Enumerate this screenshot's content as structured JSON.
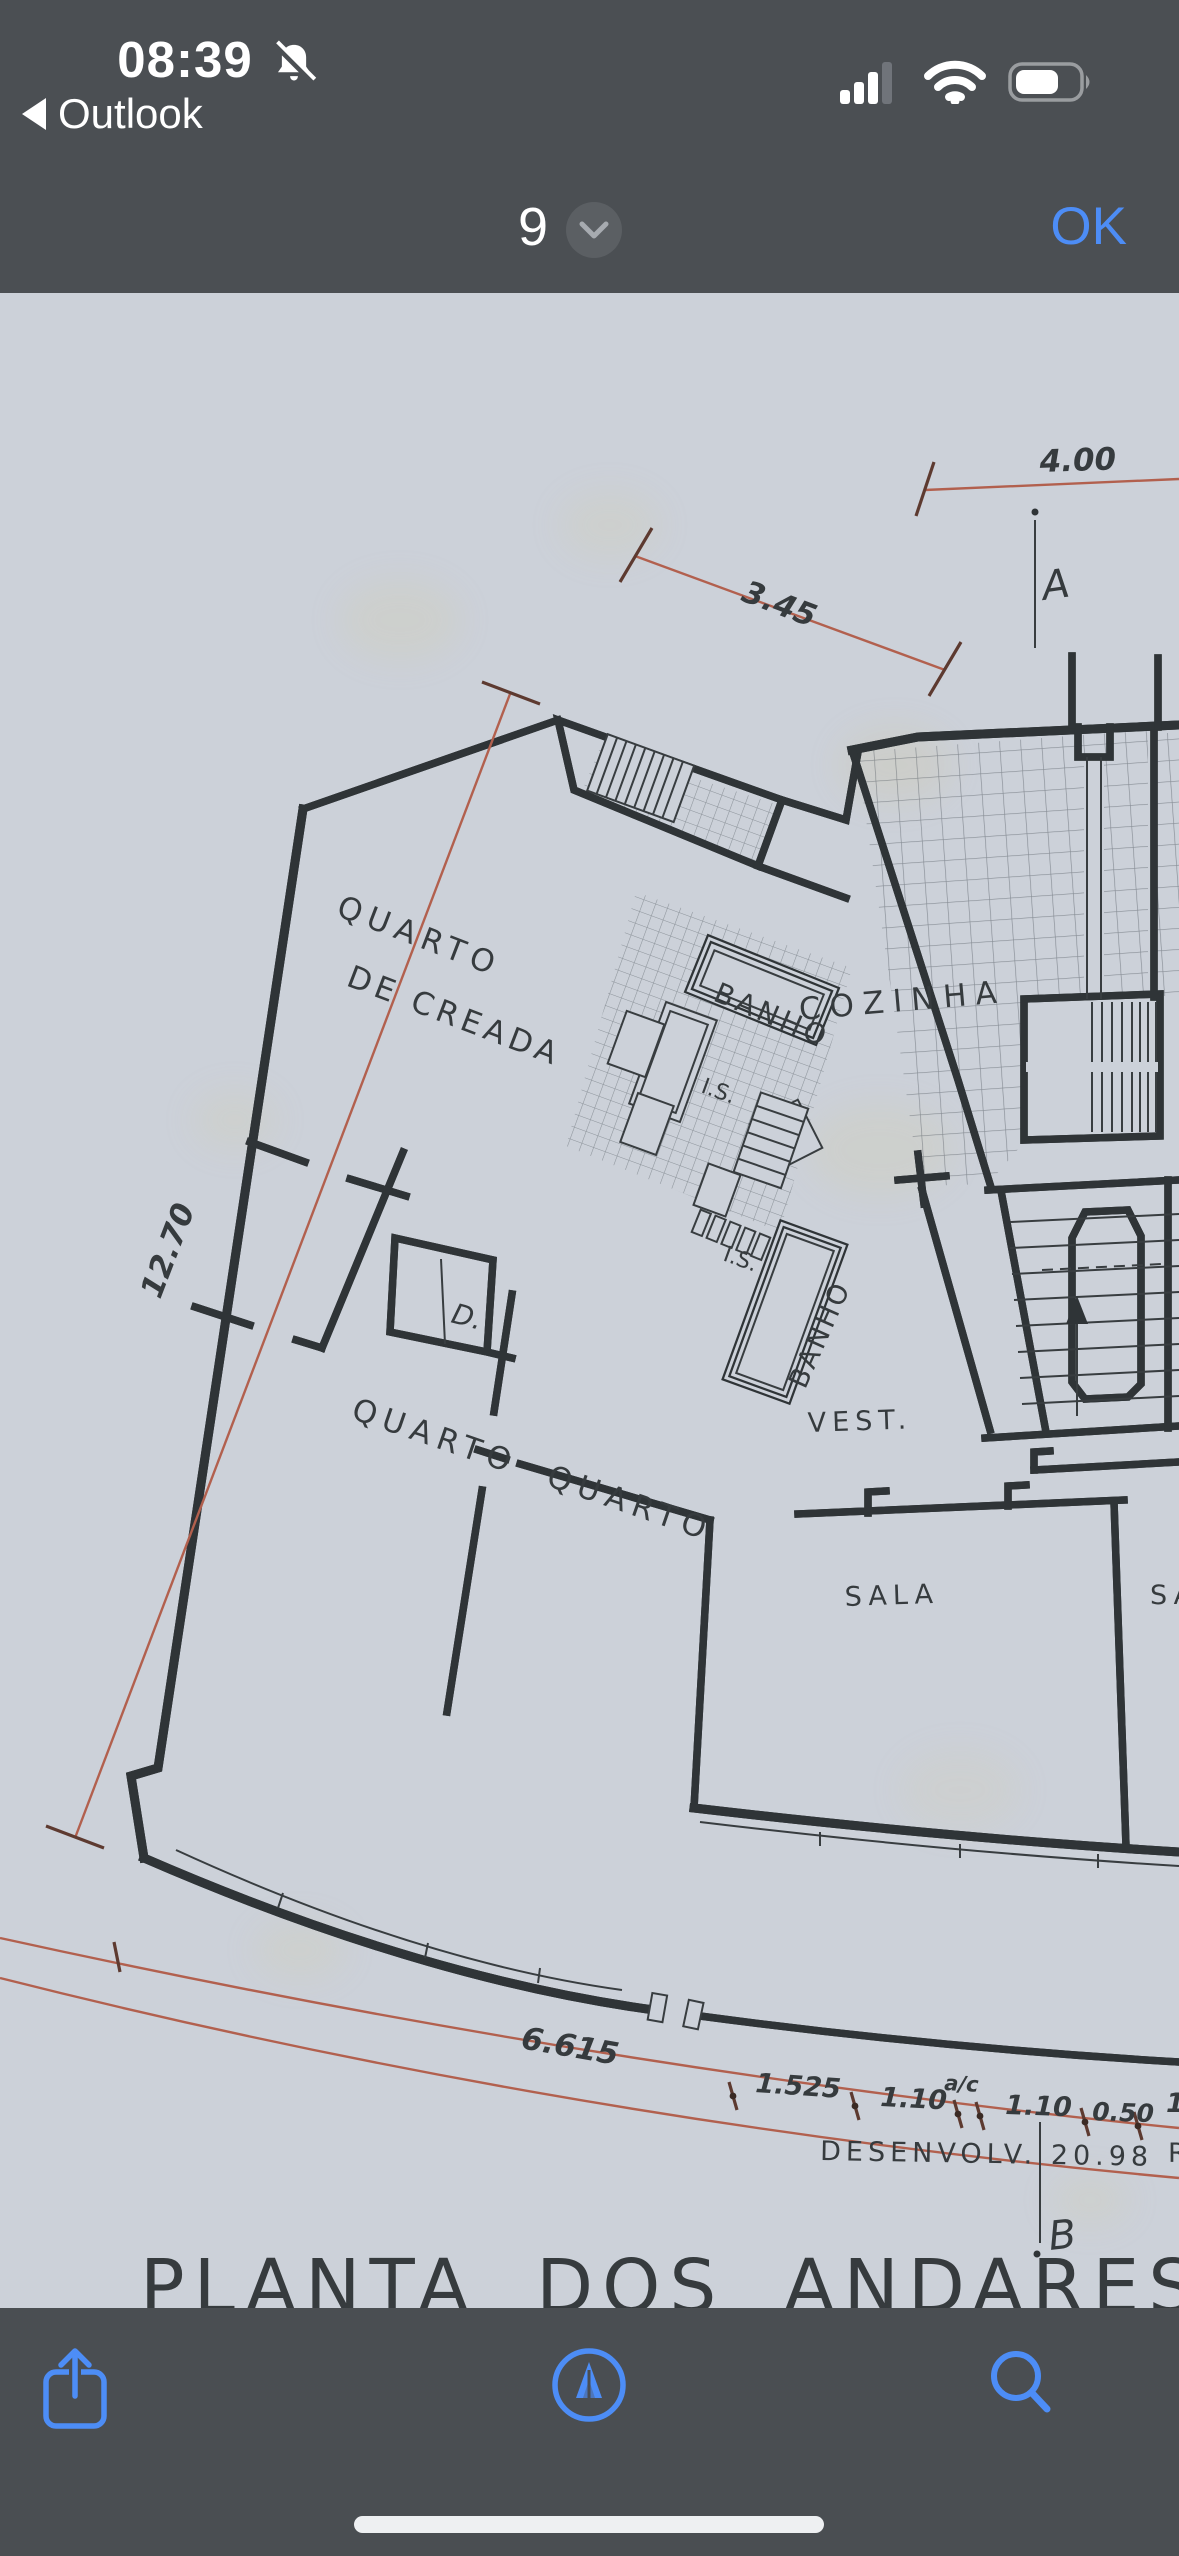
{
  "status_bar": {
    "time": "08:39",
    "back_label": "Outlook",
    "icons": [
      "notifications-off-icon",
      "cellular-signal-icon",
      "wifi-icon",
      "battery-icon"
    ]
  },
  "nav_bar": {
    "page_number": "9",
    "confirm_label": "OK"
  },
  "document": {
    "title": "PLANTA  DOS  ANDARES",
    "rooms": {
      "maid_room_line1": "QUARTO",
      "maid_room_line2": "DE CREADA",
      "bath1": "BANHO",
      "bath2": "BANHO",
      "wc1": "I.S.",
      "wc2": "I.S.",
      "kitchen": "COZINHA",
      "closet": "D.",
      "bedroom1": "QUARTO",
      "bedroom2": "QUARTO",
      "vestibule": "VEST.",
      "living": "SALA",
      "living2_partial": "SA"
    },
    "dimensions": {
      "top": "4.00",
      "upper_diagonal": "3.45",
      "left_diagonal": "12.70",
      "bottom_left": "6.615",
      "chain": [
        "1.525",
        "1.10",
        "1.10",
        "0.50"
      ],
      "chain_note": "a/c",
      "chain_partial_right": "1.",
      "development": "DESENVOLV.  20.98",
      "development_partial_right": "R"
    },
    "section_markers": {
      "top": "A",
      "bottom": "B"
    }
  },
  "toolbar": {
    "icons": [
      "share-icon",
      "markup-icon",
      "search-icon"
    ]
  },
  "colors": {
    "accent_blue": "#4D8DF6",
    "header_gray": "#4B4F53",
    "paper": "#CCD1D9",
    "ink": "#34393C",
    "dimension_red": "#B2604E"
  }
}
